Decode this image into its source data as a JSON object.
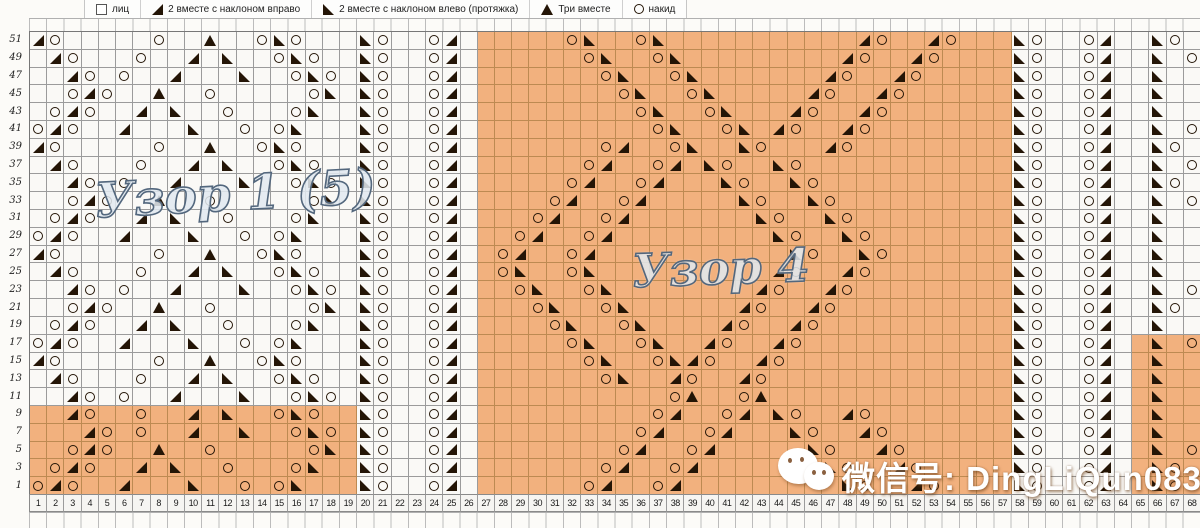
{
  "legend": {
    "items": [
      {
        "icon": "knit-square-icon",
        "label": "лиц"
      },
      {
        "icon": "decrease-right-icon",
        "label": "2 вместе с наклоном вправо"
      },
      {
        "icon": "decrease-left-icon",
        "label": "2 вместе с наклоном влево (протяжка)"
      },
      {
        "icon": "triple-decrease-icon",
        "label": "Три вместе"
      },
      {
        "icon": "yarn-over-icon",
        "label": "накид"
      }
    ]
  },
  "titles": {
    "pattern1": "Узор 1 (5)",
    "pattern4": "Узор 4"
  },
  "watermark": {
    "text": "微信号: DingLiQun0830",
    "icon": "wechat-icon"
  },
  "colors": {
    "orange": "#f2b17e",
    "orange_line": "#bd8a52",
    "line": "#9b9b9b",
    "symbol": "#241506"
  },
  "grid": {
    "symbol_key": {
      "o": "yarn-over",
      "r": "decrease-right",
      "l": "decrease-left",
      "t": "triple-decrease"
    },
    "row_labels": [
      "51",
      "49",
      "47",
      "45",
      "43",
      "41",
      "39",
      "37",
      "35",
      "33",
      "31",
      "29",
      "27",
      "25",
      "23",
      "21",
      "19",
      "17",
      "15",
      "13",
      "11",
      "9",
      "7",
      "5",
      "3",
      "1"
    ],
    "col_labels": [
      "1",
      "2",
      "3",
      "4",
      "5",
      "6",
      "7",
      "8",
      "9",
      "10",
      "11",
      "12",
      "13",
      "14",
      "15",
      "16",
      "17",
      "18",
      "19",
      "20",
      "21",
      "22",
      "23",
      "24",
      "25",
      "26",
      "27",
      "28",
      "29",
      "30",
      "31",
      "32",
      "33",
      "34",
      "35",
      "36",
      "37",
      "38",
      "39",
      "40",
      "41",
      "42",
      "43",
      "44",
      "45",
      "46",
      "47",
      "48",
      "49",
      "50",
      "51",
      "52",
      "53",
      "54",
      "55",
      "56",
      "57",
      "58",
      "59",
      "60",
      "61",
      "62",
      "63",
      "64",
      "65",
      "66",
      "67",
      "68"
    ],
    "orange_regions": [
      {
        "rows": [
          0,
          25
        ],
        "cols": [
          27,
          57
        ]
      },
      {
        "rows": [
          21,
          25
        ],
        "cols": [
          1,
          19
        ]
      },
      {
        "rows": [
          17,
          25
        ],
        "cols": [
          65,
          68
        ]
      }
    ],
    "rows": [
      {
        "label": "51",
        "cells": {
          "1": "r",
          "2": "o",
          "8": "o",
          "11": "t",
          "14": "o",
          "15": "l",
          "16": "o",
          "20": "l",
          "21": "o",
          "24": "o",
          "25": "r",
          "32": "o",
          "33": "l",
          "36": "o",
          "37": "l",
          "49": "r",
          "50": "o",
          "53": "r",
          "54": "o",
          "58": "l",
          "59": "o",
          "62": "o",
          "63": "r",
          "66": "l",
          "67": "o"
        }
      },
      {
        "label": "49",
        "cells": {
          "2": "r",
          "3": "o",
          "7": "o",
          "10": "r",
          "12": "l",
          "15": "o",
          "16": "l",
          "17": "o",
          "20": "l",
          "21": "o",
          "24": "o",
          "25": "r",
          "33": "o",
          "34": "l",
          "37": "o",
          "38": "l",
          "48": "r",
          "49": "o",
          "52": "r",
          "53": "o",
          "58": "l",
          "59": "o",
          "62": "o",
          "63": "r",
          "66": "l",
          "68": "o"
        }
      },
      {
        "label": "47",
        "cells": {
          "3": "r",
          "4": "o",
          "6": "o",
          "9": "r",
          "13": "l",
          "16": "o",
          "17": "l",
          "18": "o",
          "20": "l",
          "21": "o",
          "24": "o",
          "25": "r",
          "34": "o",
          "35": "l",
          "38": "o",
          "39": "l",
          "47": "r",
          "48": "o",
          "51": "r",
          "52": "o",
          "58": "l",
          "59": "o",
          "62": "o",
          "63": "r",
          "66": "l"
        }
      },
      {
        "label": "45",
        "cells": {
          "3": "o",
          "4": "r",
          "5": "o",
          "8": "t",
          "11": "o",
          "17": "o",
          "18": "l",
          "20": "l",
          "21": "o",
          "24": "o",
          "25": "r",
          "35": "o",
          "36": "l",
          "39": "o",
          "40": "l",
          "46": "r",
          "47": "o",
          "50": "r",
          "51": "o",
          "58": "l",
          "59": "o",
          "62": "o",
          "63": "r",
          "66": "l"
        }
      },
      {
        "label": "43",
        "cells": {
          "2": "o",
          "3": "r",
          "4": "o",
          "7": "r",
          "9": "l",
          "12": "o",
          "16": "o",
          "17": "l",
          "20": "l",
          "21": "o",
          "24": "o",
          "25": "r",
          "36": "o",
          "37": "l",
          "40": "o",
          "41": "l",
          "45": "r",
          "46": "o",
          "49": "r",
          "50": "o",
          "58": "l",
          "59": "o",
          "62": "o",
          "63": "r",
          "66": "l"
        }
      },
      {
        "label": "41",
        "cells": {
          "1": "o",
          "2": "r",
          "3": "o",
          "6": "r",
          "10": "l",
          "13": "o",
          "15": "o",
          "16": "l",
          "20": "l",
          "21": "o",
          "24": "o",
          "25": "r",
          "37": "o",
          "38": "l",
          "41": "o",
          "42": "l",
          "44": "r",
          "45": "o",
          "48": "r",
          "49": "o",
          "58": "l",
          "59": "o",
          "62": "o",
          "63": "r",
          "66": "l",
          "68": "o"
        }
      },
      {
        "label": "39",
        "cells": {
          "1": "r",
          "2": "o",
          "8": "o",
          "11": "t",
          "14": "o",
          "15": "l",
          "16": "o",
          "20": "l",
          "21": "o",
          "24": "o",
          "25": "r",
          "34": "o",
          "35": "r",
          "38": "o",
          "39": "l",
          "42": "l",
          "43": "o",
          "47": "r",
          "48": "o",
          "58": "l",
          "59": "o",
          "62": "o",
          "63": "r",
          "66": "l",
          "67": "o"
        }
      },
      {
        "label": "37",
        "cells": {
          "2": "r",
          "3": "o",
          "7": "o",
          "10": "r",
          "12": "l",
          "15": "o",
          "16": "l",
          "17": "o",
          "20": "l",
          "21": "o",
          "24": "o",
          "25": "r",
          "33": "o",
          "34": "r",
          "37": "o",
          "38": "r",
          "40": "l",
          "41": "o",
          "44": "l",
          "45": "o",
          "58": "l",
          "59": "o",
          "62": "o",
          "63": "r",
          "66": "l",
          "68": "o"
        }
      },
      {
        "label": "35",
        "cells": {
          "3": "r",
          "4": "o",
          "6": "o",
          "9": "r",
          "13": "l",
          "16": "o",
          "17": "l",
          "18": "o",
          "20": "l",
          "21": "o",
          "24": "o",
          "25": "r",
          "32": "o",
          "33": "r",
          "36": "o",
          "37": "r",
          "41": "l",
          "42": "o",
          "45": "l",
          "46": "o",
          "58": "l",
          "59": "o",
          "62": "o",
          "63": "r",
          "66": "l",
          "67": "o"
        }
      },
      {
        "label": "33",
        "cells": {
          "3": "o",
          "4": "r",
          "5": "o",
          "8": "t",
          "11": "o",
          "17": "o",
          "18": "l",
          "20": "l",
          "21": "o",
          "24": "o",
          "25": "r",
          "31": "o",
          "32": "r",
          "35": "o",
          "36": "r",
          "42": "l",
          "43": "o",
          "46": "l",
          "47": "o",
          "58": "l",
          "59": "o",
          "62": "o",
          "63": "r",
          "66": "l",
          "68": "o"
        }
      },
      {
        "label": "31",
        "cells": {
          "2": "o",
          "3": "r",
          "4": "o",
          "7": "r",
          "9": "l",
          "12": "o",
          "16": "o",
          "17": "l",
          "20": "l",
          "21": "o",
          "24": "o",
          "25": "r",
          "30": "o",
          "31": "r",
          "34": "o",
          "35": "r",
          "43": "l",
          "44": "o",
          "47": "l",
          "48": "o",
          "58": "l",
          "59": "o",
          "62": "o",
          "63": "r",
          "66": "l"
        }
      },
      {
        "label": "29",
        "cells": {
          "1": "o",
          "2": "r",
          "3": "o",
          "6": "r",
          "10": "l",
          "13": "o",
          "15": "o",
          "16": "l",
          "20": "l",
          "21": "o",
          "24": "o",
          "25": "r",
          "29": "o",
          "30": "r",
          "33": "o",
          "34": "r",
          "44": "l",
          "45": "o",
          "48": "l",
          "49": "o",
          "58": "l",
          "59": "o",
          "62": "o",
          "63": "r",
          "66": "l"
        }
      },
      {
        "label": "27",
        "cells": {
          "1": "r",
          "2": "o",
          "8": "o",
          "11": "t",
          "14": "o",
          "15": "l",
          "16": "o",
          "20": "l",
          "21": "o",
          "24": "o",
          "25": "r",
          "28": "o",
          "29": "r",
          "32": "o",
          "33": "r",
          "45": "l",
          "46": "o",
          "49": "l",
          "50": "o",
          "58": "l",
          "59": "o",
          "62": "o",
          "63": "r",
          "66": "l"
        }
      },
      {
        "label": "25",
        "cells": {
          "2": "r",
          "3": "o",
          "7": "o",
          "10": "r",
          "12": "l",
          "15": "o",
          "16": "l",
          "17": "o",
          "20": "l",
          "21": "o",
          "24": "o",
          "25": "r",
          "28": "o",
          "29": "l",
          "32": "o",
          "33": "l",
          "44": "r",
          "45": "o",
          "48": "r",
          "49": "o",
          "58": "l",
          "59": "o",
          "62": "o",
          "63": "r",
          "66": "l"
        }
      },
      {
        "label": "23",
        "cells": {
          "3": "r",
          "4": "o",
          "6": "o",
          "9": "r",
          "13": "l",
          "16": "o",
          "17": "l",
          "18": "o",
          "20": "l",
          "21": "o",
          "24": "o",
          "25": "r",
          "29": "o",
          "30": "l",
          "33": "o",
          "34": "l",
          "43": "r",
          "44": "o",
          "47": "r",
          "48": "o",
          "58": "l",
          "59": "o",
          "62": "o",
          "63": "r",
          "66": "l",
          "68": "o"
        }
      },
      {
        "label": "21",
        "cells": {
          "3": "o",
          "4": "r",
          "5": "o",
          "8": "t",
          "11": "o",
          "17": "o",
          "18": "l",
          "20": "l",
          "21": "o",
          "24": "o",
          "25": "r",
          "30": "o",
          "31": "l",
          "34": "o",
          "35": "l",
          "42": "r",
          "43": "o",
          "46": "r",
          "47": "o",
          "58": "l",
          "59": "o",
          "62": "o",
          "63": "r",
          "66": "l",
          "67": "o"
        }
      },
      {
        "label": "19",
        "cells": {
          "2": "o",
          "3": "r",
          "4": "o",
          "7": "r",
          "9": "l",
          "12": "o",
          "16": "o",
          "17": "l",
          "20": "l",
          "21": "o",
          "24": "o",
          "25": "r",
          "31": "o",
          "32": "l",
          "35": "o",
          "36": "l",
          "41": "r",
          "42": "o",
          "45": "r",
          "46": "o",
          "58": "l",
          "59": "o",
          "62": "o",
          "63": "r",
          "66": "l"
        }
      },
      {
        "label": "17",
        "cells": {
          "1": "o",
          "2": "r",
          "3": "o",
          "6": "r",
          "10": "l",
          "13": "o",
          "15": "o",
          "16": "l",
          "20": "l",
          "21": "o",
          "24": "o",
          "25": "r",
          "32": "o",
          "33": "l",
          "36": "o",
          "37": "l",
          "40": "r",
          "41": "o",
          "44": "r",
          "45": "o",
          "58": "l",
          "59": "o",
          "62": "o",
          "63": "r",
          "66": "l",
          "68": "o"
        }
      },
      {
        "label": "15",
        "cells": {
          "1": "r",
          "2": "o",
          "8": "o",
          "11": "t",
          "14": "o",
          "15": "l",
          "16": "o",
          "20": "l",
          "21": "o",
          "24": "o",
          "25": "r",
          "33": "o",
          "34": "l",
          "37": "o",
          "38": "l",
          "39": "r",
          "40": "o",
          "43": "r",
          "44": "o",
          "58": "l",
          "59": "o",
          "62": "o",
          "63": "r",
          "66": "l"
        }
      },
      {
        "label": "13",
        "cells": {
          "2": "r",
          "3": "o",
          "7": "o",
          "10": "r",
          "12": "l",
          "15": "o",
          "16": "l",
          "17": "o",
          "20": "l",
          "21": "o",
          "24": "o",
          "25": "r",
          "34": "o",
          "35": "l",
          "38": "r",
          "39": "o",
          "42": "r",
          "43": "o",
          "58": "l",
          "59": "o",
          "62": "o",
          "63": "r",
          "66": "l"
        }
      },
      {
        "label": "11",
        "cells": {
          "3": "r",
          "4": "o",
          "6": "o",
          "9": "r",
          "13": "l",
          "16": "o",
          "17": "l",
          "18": "o",
          "20": "l",
          "21": "o",
          "24": "o",
          "25": "r",
          "38": "o",
          "39": "t",
          "42": "o",
          "43": "t",
          "58": "l",
          "59": "o",
          "62": "o",
          "63": "r",
          "66": "l"
        }
      },
      {
        "label": "9",
        "cells": {
          "3": "r",
          "4": "o",
          "7": "o",
          "10": "r",
          "12": "l",
          "15": "o",
          "16": "l",
          "17": "o",
          "20": "l",
          "21": "o",
          "24": "o",
          "25": "r",
          "37": "o",
          "38": "r",
          "41": "o",
          "42": "r",
          "44": "l",
          "45": "o",
          "48": "r",
          "49": "o",
          "58": "l",
          "59": "o",
          "62": "o",
          "63": "r",
          "66": "l"
        }
      },
      {
        "label": "7",
        "cells": {
          "4": "r",
          "5": "o",
          "7": "o",
          "10": "r",
          "13": "l",
          "16": "o",
          "17": "l",
          "18": "o",
          "20": "l",
          "21": "o",
          "24": "o",
          "25": "r",
          "36": "o",
          "37": "r",
          "40": "o",
          "41": "r",
          "45": "l",
          "46": "o",
          "49": "r",
          "50": "o",
          "58": "l",
          "59": "o",
          "62": "o",
          "63": "r",
          "66": "l"
        }
      },
      {
        "label": "5",
        "cells": {
          "3": "o",
          "4": "r",
          "5": "o",
          "8": "t",
          "11": "o",
          "17": "o",
          "18": "l",
          "20": "l",
          "21": "o",
          "24": "o",
          "25": "r",
          "35": "o",
          "36": "r",
          "39": "o",
          "40": "r",
          "46": "l",
          "47": "o",
          "50": "r",
          "51": "o",
          "58": "l",
          "59": "o",
          "62": "o",
          "63": "r",
          "66": "l",
          "68": "o"
        }
      },
      {
        "label": "3",
        "cells": {
          "2": "o",
          "3": "r",
          "4": "o",
          "7": "r",
          "9": "l",
          "12": "o",
          "16": "o",
          "17": "l",
          "20": "l",
          "21": "o",
          "24": "o",
          "25": "r",
          "34": "o",
          "35": "r",
          "38": "o",
          "39": "r",
          "47": "l",
          "48": "o",
          "51": "r",
          "52": "o",
          "58": "l",
          "59": "o",
          "62": "o",
          "63": "r",
          "66": "l",
          "67": "o"
        }
      },
      {
        "label": "1",
        "cells": {
          "1": "o",
          "2": "r",
          "3": "o",
          "6": "r",
          "10": "l",
          "13": "o",
          "15": "o",
          "16": "l",
          "20": "l",
          "21": "o",
          "24": "o",
          "25": "r",
          "33": "o",
          "34": "r",
          "37": "o",
          "38": "r",
          "48": "l",
          "49": "o",
          "52": "r",
          "53": "o",
          "58": "l",
          "59": "o",
          "62": "o",
          "63": "r",
          "66": "l",
          "67": "o"
        }
      }
    ]
  }
}
